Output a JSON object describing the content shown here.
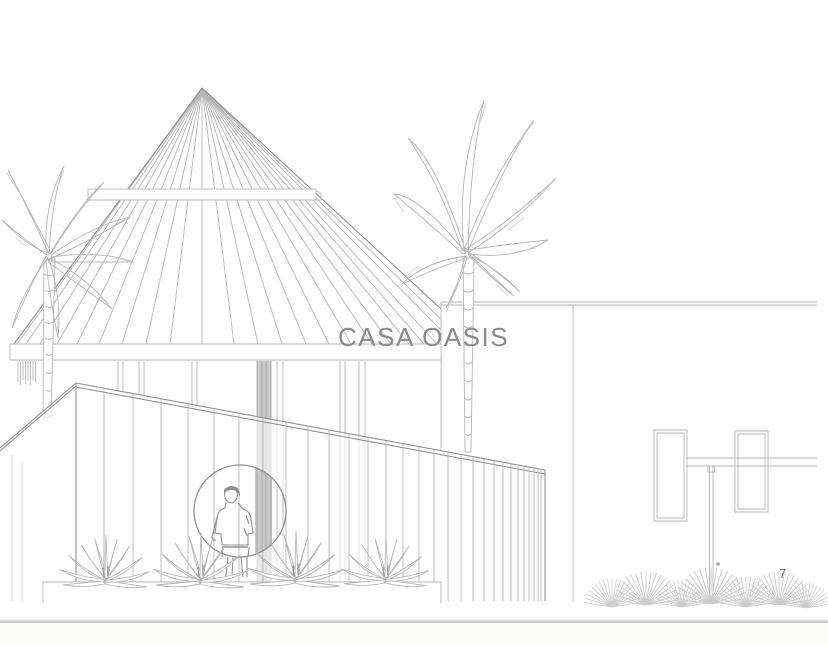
{
  "page": {
    "title": "CASA OASIS",
    "page_number": "7"
  },
  "colors": {
    "page-background": "#ffffff",
    "sketch-line": "#b5b5b5",
    "sketch-line-faint": "#cccccc",
    "sketch-line-dark": "#8f8f8f",
    "column-shade": "#c9c9c9",
    "column-edge": "#a2a2a2",
    "title-text": "#8a8a8a",
    "page-number-text": "#6e6e6e",
    "page-edge-line": "#bcbcbc",
    "footer-background": "#fcfcfb"
  },
  "illustration": {
    "elements": [
      "conical-roof",
      "roof-ring-band",
      "eave-fascia",
      "colonnade",
      "building-outline",
      "palm-tree-right",
      "palm-tree-left",
      "board-wall",
      "porthole-window",
      "person-figure",
      "planter-box",
      "agave-plants",
      "outdoor-shower-frame",
      "fan-palm-grass"
    ]
  }
}
